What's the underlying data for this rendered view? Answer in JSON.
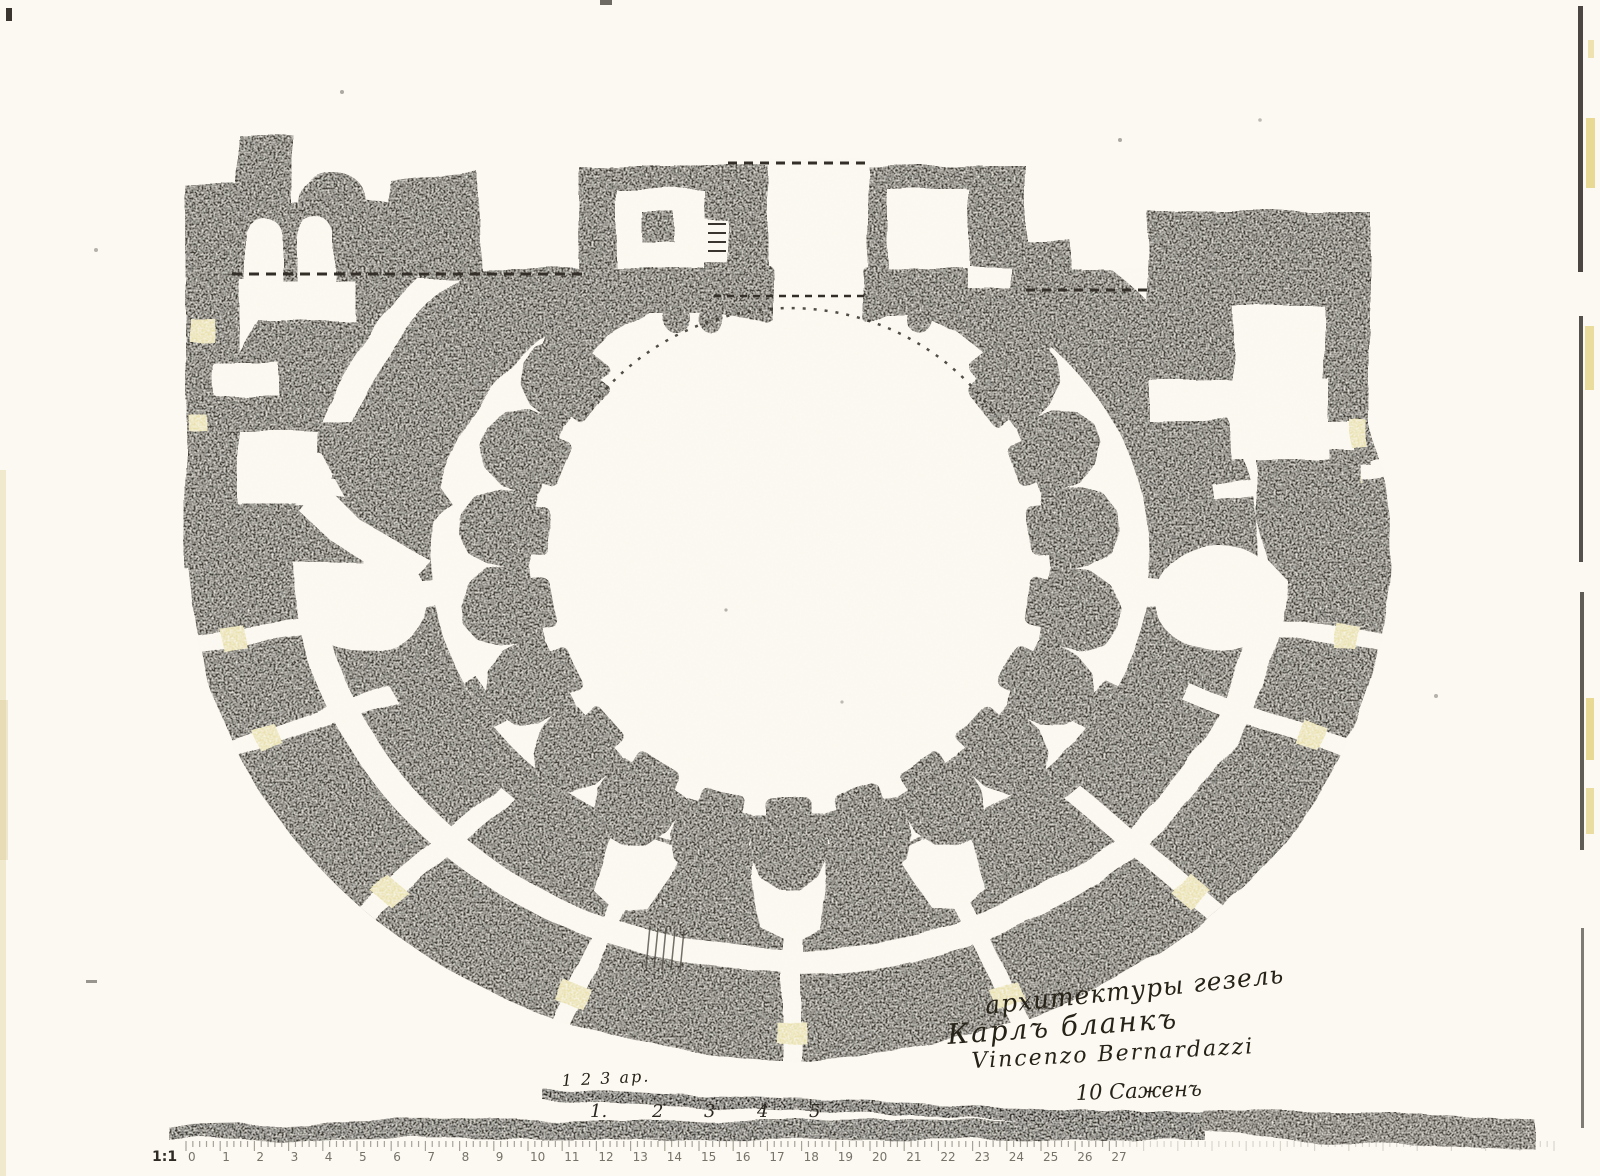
{
  "page": {
    "paper_color": "#fbf9f2",
    "ink_color": "#403c34",
    "patch_color": "#eae1ae",
    "ruler_band_color": "#3b3730"
  },
  "annotations": {
    "line1": "архитектуры гезель",
    "line2": "Карлъ бланкъ",
    "line3": "Vincenzo Bernardazzi",
    "scale_note": "10 Саженъ"
  },
  "scale_bar": {
    "top_label": "1 2 3 ар.",
    "numbers": [
      "1.",
      "2",
      "3",
      "4",
      "5"
    ]
  },
  "ruler": {
    "scale_label": "1:1",
    "numbers": [
      "0",
      "1",
      "2",
      "3",
      "4",
      "5",
      "6",
      "7",
      "8",
      "9",
      "10",
      "11",
      "12",
      "13",
      "14",
      "15",
      "16",
      "17",
      "18",
      "19",
      "20",
      "21",
      "22",
      "23",
      "24",
      "25",
      "26",
      "27"
    ]
  }
}
